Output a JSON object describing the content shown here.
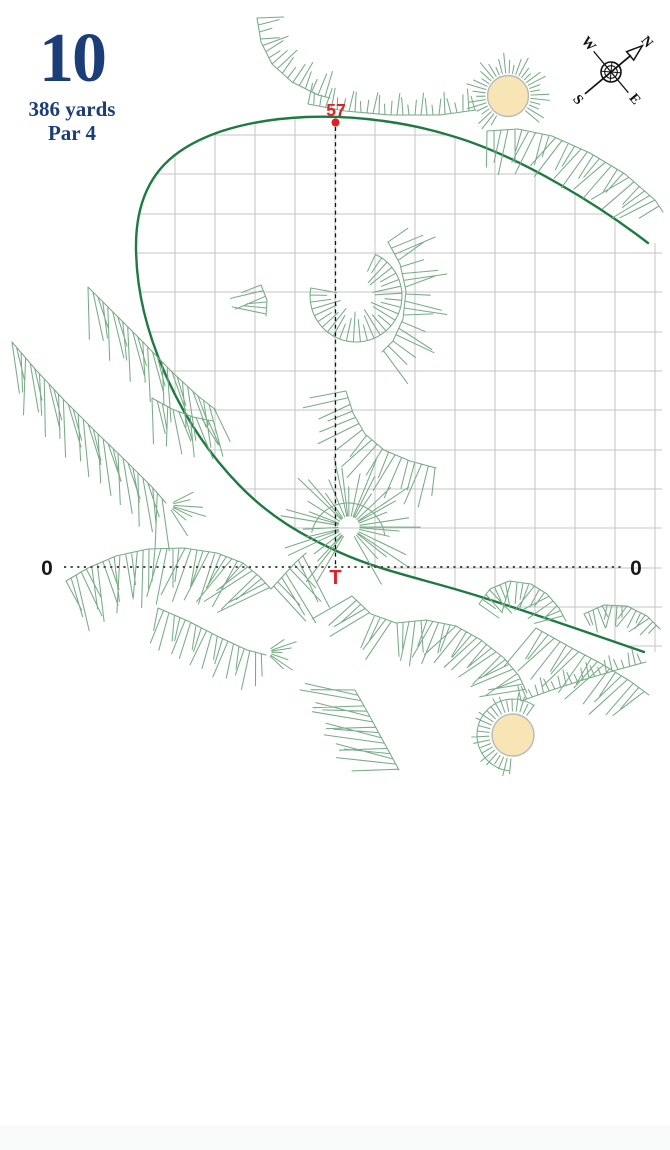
{
  "header": {
    "hole_number": "10",
    "yardage": "386 yards",
    "par": "Par 4"
  },
  "map": {
    "carry_marker": {
      "label": "57"
    },
    "tee_marker": {
      "label": "T"
    },
    "zero_left": "0",
    "zero_right": "0",
    "compass": {
      "n": "N",
      "e": "E",
      "s": "S",
      "w": "W"
    }
  },
  "colors": {
    "accent_navy": "#1b3d78",
    "marker_red": "#e31e26",
    "fairway_green": "#1e7a41",
    "hatch_green": "#78ab86",
    "grid_gray": "#c4c4c4",
    "bunker_sand": "#f8e5b6"
  }
}
